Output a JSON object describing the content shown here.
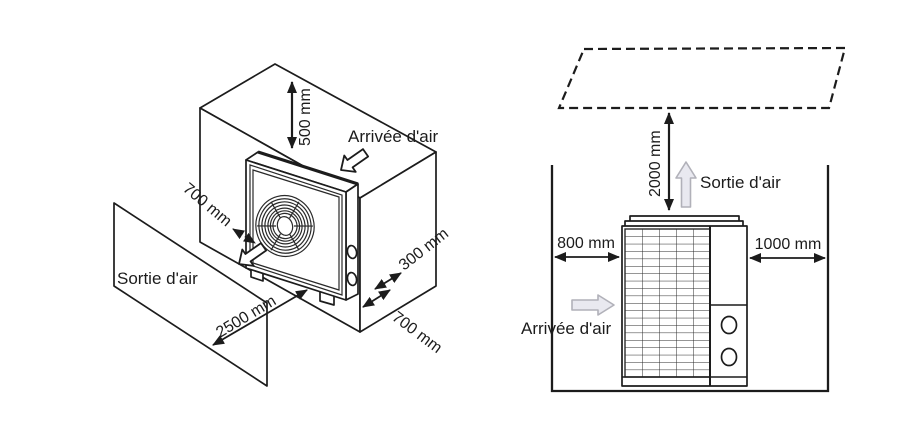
{
  "diagrams": {
    "left": {
      "name": "Isometric side clearance view",
      "air_inlet_label": "Arrivée d'air",
      "air_outlet_label": "Sortie d'air",
      "dim_top_clearance": "500 mm",
      "dim_back_wall_gap": "700 mm",
      "dim_front_clearance": "2500 mm",
      "dim_side_clearance": "300 mm",
      "dim_side_floor_clearance": "700 mm"
    },
    "right": {
      "name": "Front clearance view",
      "air_inlet_label": "Arrivée d'air",
      "air_outlet_label": "Sortie d'air",
      "dim_ceiling_clearance": "2000 mm",
      "dim_left_clearance": "800 mm",
      "dim_right_clearance": "1000 mm"
    }
  },
  "colors": {
    "background": "#ffffff",
    "line": "#1c1c1c",
    "flow_arrow_fill": "#e9e9f0",
    "flow_arrow_stroke": "#b1b1b9"
  }
}
